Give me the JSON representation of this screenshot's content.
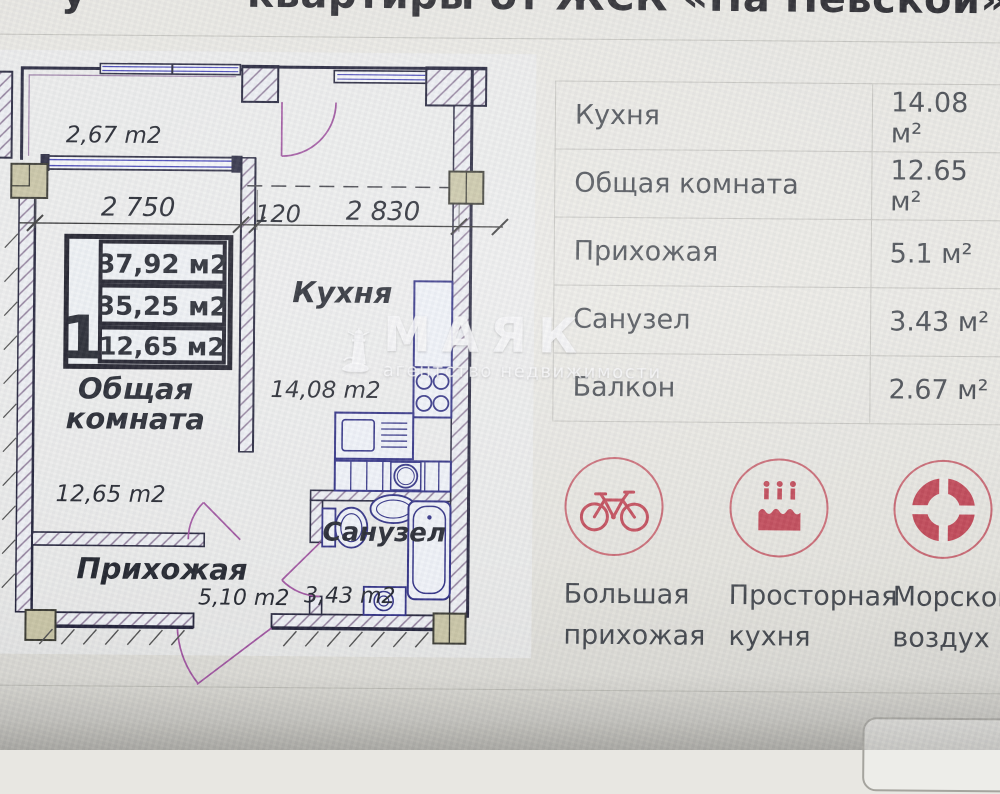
{
  "page": {
    "title_fragment": "у",
    "title": "квартиры от ЖСК «На Невской»"
  },
  "plan": {
    "balcony_area": "2,67 m2",
    "dim_left": "2 750",
    "dim_mid": "120",
    "dim_right": "2 830",
    "unit_number": "1",
    "area_total": "37,92 м2",
    "area_living_total": "35,25 м2",
    "area_room": "12,65 м2",
    "kitchen_label": "Кухня",
    "kitchen_area": "14,08 m2",
    "living_label_line1": "Общая",
    "living_label_line2": "комната",
    "living_area": "12,65 m2",
    "hall_label": "Прихожая",
    "hall_area": "5,10 m2",
    "bath_label": "Санузел",
    "bath_area": "3,43 m2"
  },
  "watermark": {
    "brand": "МАЯК",
    "tagline": "агентство недвижимости",
    "logo": "lighthouse-icon"
  },
  "area_table": {
    "rows": [
      {
        "label": "Кухня",
        "value": "14.08 м²"
      },
      {
        "label": "Общая комната",
        "value": "12.65 м²"
      },
      {
        "label": "Прихожая",
        "value": "5.1 м²"
      },
      {
        "label": "Санузел",
        "value": "3.43 м²"
      },
      {
        "label": "Балкон",
        "value": "2.67 м²"
      }
    ]
  },
  "features": [
    {
      "icon": "bicycle-icon",
      "line1": "Большая",
      "line2": "прихожая"
    },
    {
      "icon": "cake-icon",
      "line1": "Просторная",
      "line2": "кухня"
    },
    {
      "icon": "lifebuoy-icon",
      "line1": "Морской",
      "line2": "воздух"
    }
  ],
  "colors": {
    "accent_red": "#bf4352",
    "plan_wall": "#1b1b33",
    "plan_fixture": "#26267e",
    "plan_door": "#9b4d9b",
    "text_dark": "#45494f"
  }
}
